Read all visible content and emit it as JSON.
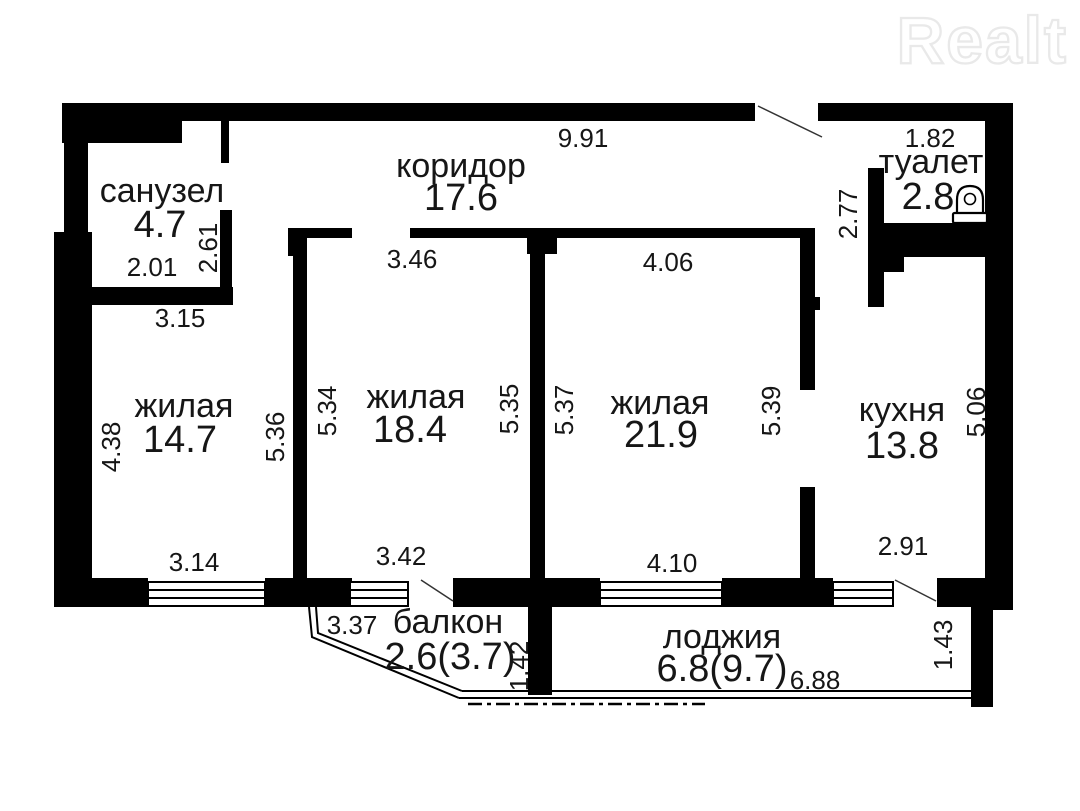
{
  "watermark": {
    "text": "Realt"
  },
  "rooms": {
    "sanuzel": {
      "name": "санузел",
      "area": "4.7"
    },
    "koridor": {
      "name": "коридор",
      "area": "17.6"
    },
    "tualet": {
      "name": "туалет",
      "area": "2.8"
    },
    "zhilaya1": {
      "name": "жилая",
      "area": "14.7"
    },
    "zhilaya2": {
      "name": "жилая",
      "area": "18.4"
    },
    "zhilaya3": {
      "name": "жилая",
      "area": "21.9"
    },
    "kuhnya": {
      "name": "кухня",
      "area": "13.8"
    },
    "balkon": {
      "name": "балкон",
      "area": "2.6(3.7)"
    },
    "lodzhiya": {
      "name": "лоджия",
      "area": "6.8(9.7)"
    }
  },
  "dims": {
    "koridor_top": "9.91",
    "tualet_top": "1.82",
    "tualet_left": "2.77",
    "sanuzel_width": "2.01",
    "sanuzel_right": "2.61",
    "sanuzel_below": "3.15",
    "door_zhilaya2": "3.46",
    "door_zhilaya3": "4.06",
    "zhilaya1_left": "4.38",
    "zhilaya1_right": "5.36",
    "zhilaya2_left": "5.34",
    "zhilaya2_right": "5.35",
    "zhilaya3_left": "5.37",
    "zhilaya3_right": "5.39",
    "kuhnya_right": "5.06",
    "zhilaya1_bottom": "3.14",
    "zhilaya2_bottom": "3.42",
    "zhilaya3_bottom": "4.10",
    "kuhnya_bottom": "2.91",
    "balkon_top": "3.37",
    "balkon_right": "1.42",
    "lodzhiya_bottom": "6.88",
    "lodzhiya_right": "1.43"
  },
  "colors": {
    "wall": "#000000",
    "text": "#161616",
    "watermark": "#e9e9e9"
  }
}
